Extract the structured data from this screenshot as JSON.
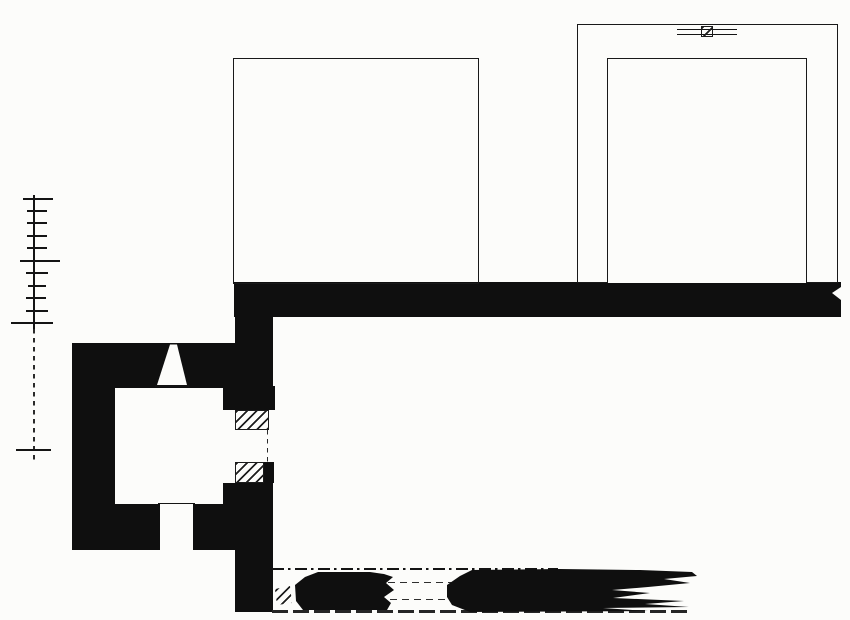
{
  "meta": {
    "description": "monochrome archaeological floor plan drawing",
    "canvas": {
      "width": 850,
      "height": 620
    },
    "colors": {
      "ink": "#0f0f0f",
      "paper": "#fcfcfa",
      "hatch_line": "#1d1d1d"
    }
  },
  "plan": {
    "scale_bar": {
      "x": 33,
      "line_thickness": 1.8,
      "tick_thickness": 2,
      "solid_line": {
        "y1": 195,
        "y2": 329
      },
      "dashed_line": {
        "y1": 329,
        "y2": 463
      },
      "ticks": [
        {
          "x1": 23,
          "x2": 53,
          "y": 198
        },
        {
          "x1": 27,
          "x2": 47,
          "y": 210
        },
        {
          "x1": 27,
          "x2": 47,
          "y": 222
        },
        {
          "x1": 27,
          "x2": 47,
          "y": 235
        },
        {
          "x1": 27,
          "x2": 47,
          "y": 247
        },
        {
          "x1": 20,
          "x2": 60,
          "y": 260
        },
        {
          "x1": 26,
          "x2": 48,
          "y": 272
        },
        {
          "x1": 28,
          "x2": 46,
          "y": 285
        },
        {
          "x1": 26,
          "x2": 46,
          "y": 297
        },
        {
          "x1": 26,
          "x2": 48,
          "y": 310
        },
        {
          "x1": 11,
          "x2": 53,
          "y": 322
        },
        {
          "x1": 16,
          "x2": 51,
          "y": 449
        }
      ]
    },
    "elements": [
      {
        "name": "main-wall-band",
        "cls": "ink",
        "x": 234,
        "y": 282,
        "w": 607,
        "h": 35
      },
      {
        "name": "band-right-notch",
        "cls": "paper",
        "pts": [
          [
            841,
            287
          ],
          [
            832,
            293
          ],
          [
            841,
            300
          ]
        ]
      },
      {
        "name": "cross-wall-upper",
        "cls": "ink",
        "x": 235,
        "y": 282,
        "w": 38,
        "h": 128
      },
      {
        "name": "cross-wall-door-north-chunk",
        "cls": "ink",
        "x": 223,
        "y": 386,
        "w": 52,
        "h": 24
      },
      {
        "name": "cross-wall-lower",
        "cls": "ink",
        "x": 223,
        "y": 483,
        "w": 50,
        "h": 67
      },
      {
        "name": "cross-wall-door-south-sliver",
        "cls": "ink",
        "x": 263,
        "y": 462,
        "w": 11,
        "h": 21
      },
      {
        "name": "cross-wall-south",
        "cls": "ink",
        "x": 235,
        "y": 550,
        "w": 38,
        "h": 62
      },
      {
        "name": "room-north-wall",
        "cls": "ink",
        "x": 72,
        "y": 343,
        "w": 163,
        "h": 45
      },
      {
        "name": "room-west-wall",
        "cls": "ink",
        "x": 72,
        "y": 388,
        "w": 43,
        "h": 162
      },
      {
        "name": "room-south-wall-west",
        "cls": "ink",
        "x": 72,
        "y": 504,
        "w": 88,
        "h": 46
      },
      {
        "name": "room-south-wall-east",
        "cls": "ink",
        "x": 193,
        "y": 504,
        "w": 34,
        "h": 46
      },
      {
        "name": "window-splay-opening",
        "cls": "paper",
        "pts": [
          [
            170,
            344.5
          ],
          [
            177,
            344.5
          ],
          [
            187,
            385
          ],
          [
            157,
            385
          ]
        ]
      },
      {
        "name": "window-inner-face-line",
        "cls": "line-solid",
        "x": 155,
        "y": 385,
        "w": 34,
        "h": 1.5
      },
      {
        "name": "south-door-inner-line",
        "cls": "line-solid",
        "x": 158,
        "y": 503,
        "w": 37,
        "h": 1.3
      },
      {
        "name": "east-door-north-jamb",
        "cls": "hatch brd",
        "x": 235,
        "y": 410,
        "w": 34,
        "h": 20
      },
      {
        "name": "east-door-south-jamb",
        "cls": "hatch brd",
        "x": 235,
        "y": 462,
        "w": 29,
        "h": 21
      },
      {
        "name": "east-door-swing-line",
        "cls": "line-vdash",
        "x": 267,
        "y": 430,
        "w": 1.3,
        "h": 32
      },
      {
        "name": "courtyard-outline",
        "cls": "outline",
        "x": 233,
        "y": 58,
        "w": 246,
        "h": 226
      },
      {
        "name": "tower-walls-hatched",
        "cls": "hatch outline",
        "x": 577,
        "y": 24,
        "w": 261,
        "h": 259
      },
      {
        "name": "tower-interior",
        "cls": "paper",
        "x": 607,
        "y": 58,
        "w": 200,
        "h": 225,
        "borders": "tlr"
      },
      {
        "name": "tower-entrance-splay",
        "cls": "paper",
        "pts": [
          [
            677,
            26.5
          ],
          [
            737,
            26.5
          ],
          [
            745,
            57.5
          ],
          [
            672,
            57.5
          ]
        ]
      },
      {
        "name": "tower-entrance-outer-line",
        "cls": "line-solid",
        "x": 677,
        "y": 29,
        "w": 60,
        "h": 1.2
      },
      {
        "name": "tower-entrance-inner-line",
        "cls": "line-solid",
        "x": 677,
        "y": 34,
        "w": 60,
        "h": 1.2
      },
      {
        "name": "tower-entrance-pivot-block",
        "cls": "hatch brd",
        "x": 701,
        "y": 25.5,
        "w": 12,
        "h": 11
      },
      {
        "name": "ruin-axis-dashdot-line",
        "cls": "line-dashdot",
        "x": 272,
        "y": 568,
        "w": 286,
        "h": 1.6
      },
      {
        "name": "ruin-gap-dash-upper",
        "cls": "line-dash",
        "x": 388,
        "y": 582,
        "w": 64,
        "h": 1.4
      },
      {
        "name": "ruin-gap-dash-lower",
        "cls": "line-dash",
        "x": 390,
        "y": 599,
        "w": 60,
        "h": 1.4
      },
      {
        "name": "ruin-base-broken-line",
        "cls": "line-dash2",
        "x": 272,
        "y": 610,
        "w": 420,
        "h": 2.6
      },
      {
        "name": "ruin-fragment-west",
        "cls": "ink",
        "pts": [
          [
            295,
            585
          ],
          [
            305,
            577
          ],
          [
            318,
            572
          ],
          [
            370,
            572
          ],
          [
            384,
            574
          ],
          [
            393,
            577
          ],
          [
            386,
            583
          ],
          [
            394,
            590
          ],
          [
            384,
            597
          ],
          [
            391,
            603
          ],
          [
            387,
            610
          ],
          [
            303,
            610
          ],
          [
            296,
            601
          ]
        ]
      },
      {
        "name": "ruin-fragment-east",
        "cls": "ink",
        "pts": [
          [
            447,
            585
          ],
          [
            460,
            576
          ],
          [
            472,
            570
          ],
          [
            560,
            569
          ],
          [
            640,
            570
          ],
          [
            692,
            572
          ],
          [
            697,
            576
          ],
          [
            664,
            579
          ],
          [
            690,
            583
          ],
          [
            648,
            587
          ],
          [
            612,
            590
          ],
          [
            650,
            593
          ],
          [
            613,
            598
          ],
          [
            684,
            601
          ],
          [
            645,
            604
          ],
          [
            689,
            607
          ],
          [
            603,
            608
          ],
          [
            648,
            611
          ],
          [
            470,
            612
          ],
          [
            452,
            605
          ],
          [
            447,
            597
          ]
        ]
      },
      {
        "name": "ruin-hatch-fragment",
        "cls": "hatch",
        "pts": [
          [
            275,
            589
          ],
          [
            290,
            586
          ],
          [
            292,
            603
          ],
          [
            277,
            605
          ]
        ]
      }
    ]
  }
}
